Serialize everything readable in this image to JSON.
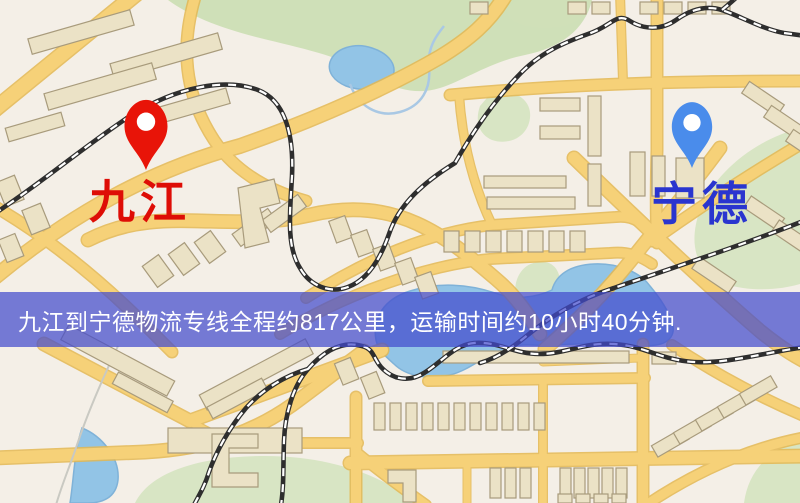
{
  "map": {
    "origin": {
      "label": "九江",
      "marker": "red-map-pin"
    },
    "destination": {
      "label": "宁德",
      "marker": "blue-map-pin"
    }
  },
  "banner": {
    "text": "九江到宁德物流专线全程约817公里，运输时间约10小时40分钟."
  },
  "colors": {
    "map_background": "#f4efe7",
    "road_fill": "#f6d178",
    "road_casing": "#e4b852",
    "park_green": "#cfe0b8",
    "water_blue": "#92c4e6",
    "building_fill": "#ebe2c6",
    "railway_dark": "#2e2e2e",
    "origin_pin": "#e81408",
    "origin_label": "#de0d06",
    "destination_pin": "#4a8ceb",
    "destination_label": "#2a35cf",
    "banner_background": "rgba(67,75,205,0.72)",
    "banner_text": "#ffffff"
  }
}
